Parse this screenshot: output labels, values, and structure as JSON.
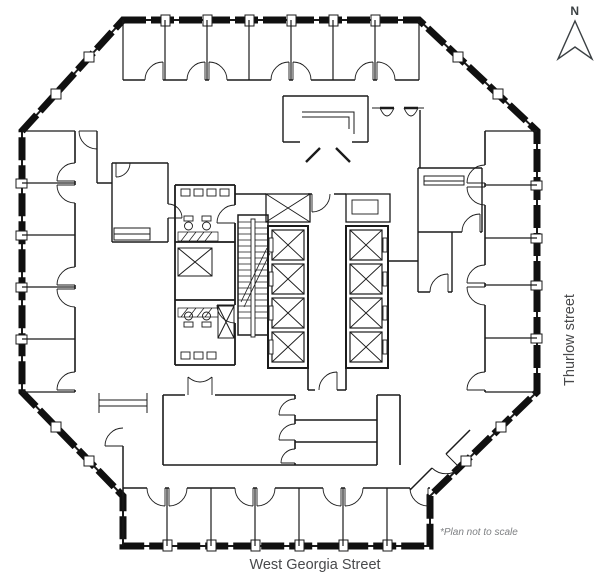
{
  "canvas": {
    "background": "#ffffff",
    "colors": {
      "wall_line": "#1b1b1b",
      "glazing_band": "#111111",
      "street_text": "#48494b",
      "muted_text": "#7e8083",
      "north_indicator": "#3b4043"
    }
  },
  "north_indicator": {
    "label": "N"
  },
  "labels": {
    "street_bottom": "West Georgia Street",
    "street_right": "Thurlow street",
    "disclaimer": "*Plan not to scale"
  }
}
